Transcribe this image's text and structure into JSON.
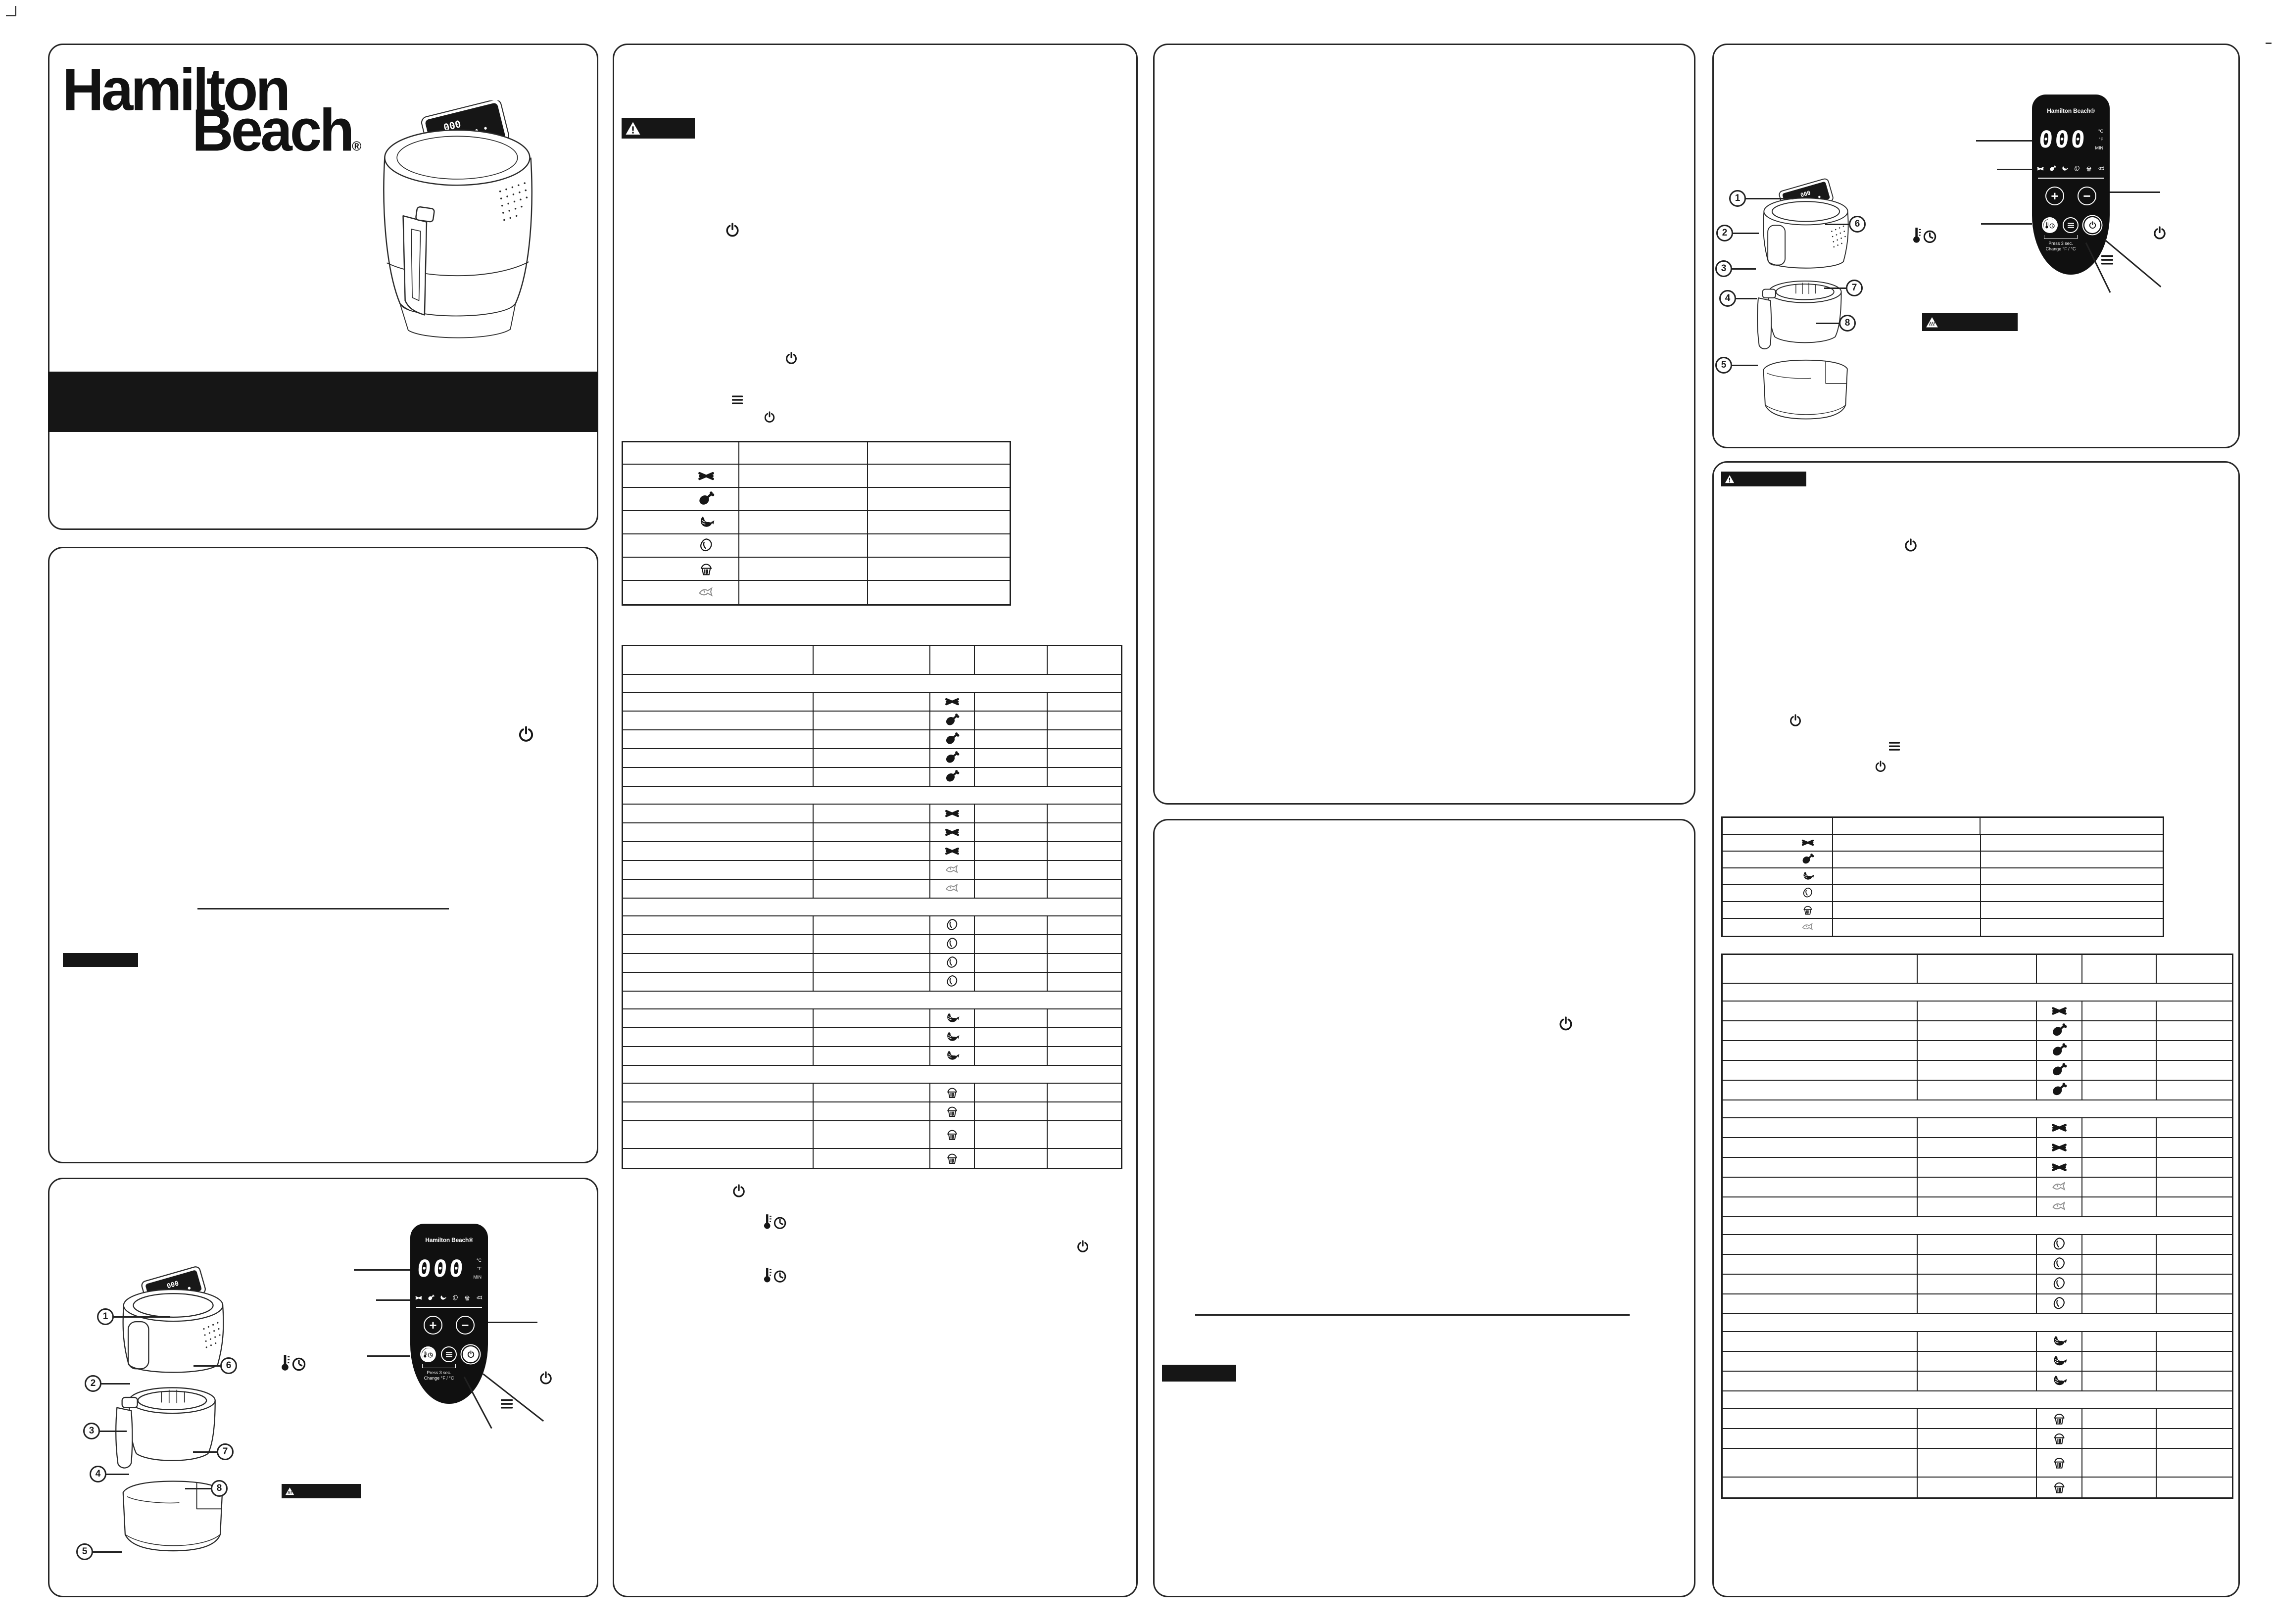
{
  "brand": {
    "logo_line1": "Hamilton",
    "logo_line2": "Beach",
    "registered_mark": "®"
  },
  "cover": {
    "title_bar_text": ""
  },
  "control_panel": {
    "brand": "Hamilton Beach®",
    "display_value": "000",
    "unit_celsius": "°C",
    "unit_fahrenheit": "°F",
    "unit_minutes": "MIN",
    "plus_label": "+",
    "minus_label": "−",
    "mode_icons": [
      "fries-icon",
      "drumstick-icon",
      "shrimp-icon",
      "steak-icon",
      "muffin-icon",
      "fish-icon"
    ],
    "buttons": [
      "temp-time-button",
      "menu-button",
      "power-button"
    ],
    "hint_line1": "Press 3 sec.",
    "hint_line2": "Change °F / °C"
  },
  "parts_callouts": [
    "1",
    "2",
    "3",
    "4",
    "5",
    "6",
    "7",
    "8"
  ],
  "chips": {
    "warning_chip_text": "",
    "hot_surface_chip_text": "",
    "important_chip_text": ""
  },
  "icons_legend": [
    "power-icon",
    "menu-icon",
    "thermometer-clock-icon",
    "warning-triangle-icon",
    "hot-surface-icon",
    "fries-icon",
    "drumstick-icon",
    "shrimp-icon",
    "steak-icon",
    "muffin-icon",
    "fish-icon"
  ],
  "tables": {
    "cook_guide": {
      "columns": 3,
      "header": [
        "",
        "",
        ""
      ],
      "rows": [
        {
          "icon": "fries-icon"
        },
        {
          "icon": "drumstick-icon"
        },
        {
          "icon": "shrimp-icon"
        },
        {
          "icon": "steak-icon"
        },
        {
          "icon": "muffin-icon"
        },
        {
          "icon": "fish-icon"
        }
      ]
    },
    "cook_chart": {
      "columns": 5,
      "rows": [
        {
          "type": "header"
        },
        {
          "type": "separator"
        },
        {
          "type": "item",
          "icon": "fries-icon"
        },
        {
          "type": "item",
          "icon": "drumstick-icon"
        },
        {
          "type": "item",
          "icon": "drumstick-icon"
        },
        {
          "type": "item",
          "icon": "drumstick-icon"
        },
        {
          "type": "item",
          "icon": "drumstick-icon"
        },
        {
          "type": "separator"
        },
        {
          "type": "item",
          "icon": "fries-icon"
        },
        {
          "type": "item",
          "icon": "fries-icon"
        },
        {
          "type": "item",
          "icon": "fries-icon"
        },
        {
          "type": "item",
          "icon": "fish-icon"
        },
        {
          "type": "item",
          "icon": "fish-icon"
        },
        {
          "type": "separator"
        },
        {
          "type": "item",
          "icon": "steak-icon"
        },
        {
          "type": "item",
          "icon": "steak-icon"
        },
        {
          "type": "item",
          "icon": "steak-icon"
        },
        {
          "type": "item",
          "icon": "steak-icon"
        },
        {
          "type": "separator"
        },
        {
          "type": "item",
          "icon": "shrimp-icon"
        },
        {
          "type": "item",
          "icon": "shrimp-icon"
        },
        {
          "type": "item",
          "icon": "shrimp-icon"
        },
        {
          "type": "separator"
        },
        {
          "type": "item",
          "icon": "muffin-icon"
        },
        {
          "type": "item",
          "icon": "muffin-icon"
        },
        {
          "type": "item",
          "icon": "muffin-icon",
          "tall": true
        },
        {
          "type": "item",
          "icon": "muffin-icon"
        }
      ]
    }
  }
}
